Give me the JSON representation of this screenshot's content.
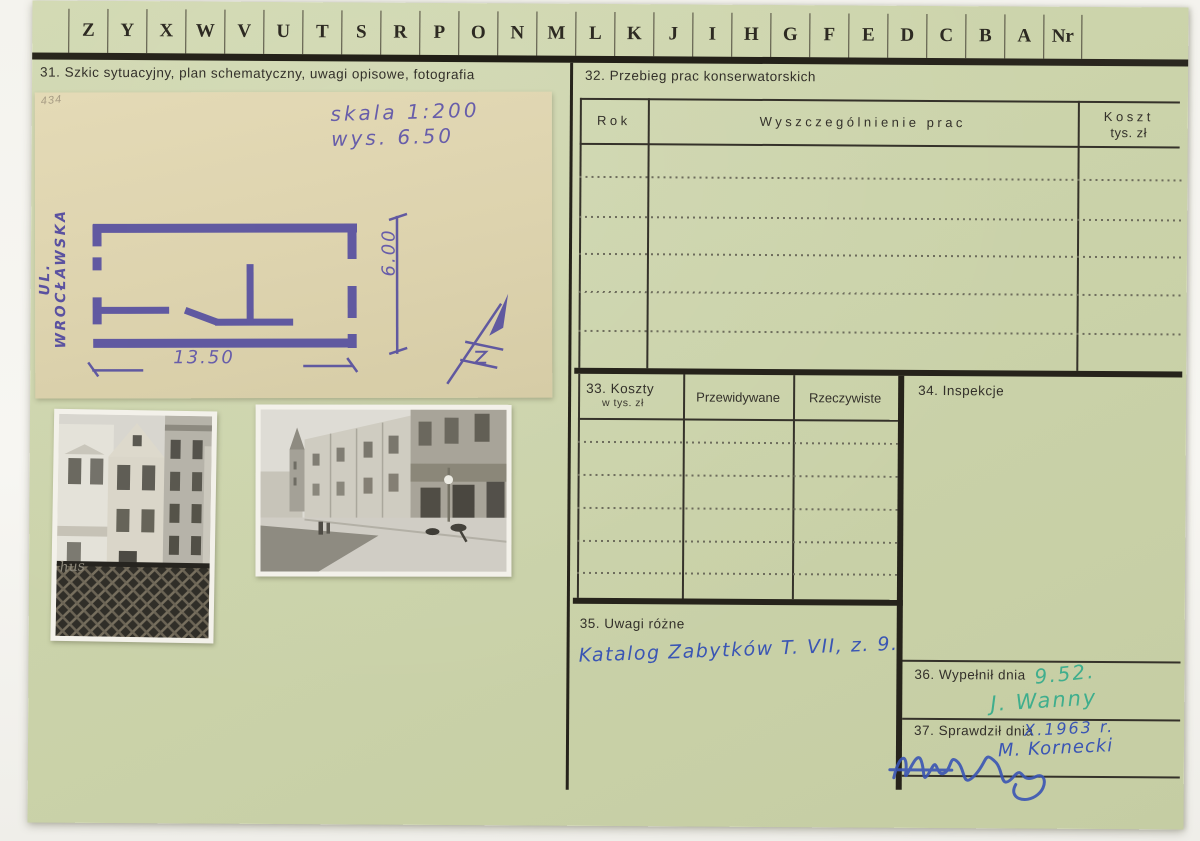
{
  "index_strip": {
    "letters": [
      "Z",
      "Y",
      "X",
      "W",
      "V",
      "U",
      "T",
      "S",
      "R",
      "P",
      "O",
      "N",
      "M",
      "L",
      "K",
      "J",
      "I",
      "H",
      "G",
      "F",
      "E",
      "D",
      "C",
      "B",
      "A",
      "Nr"
    ]
  },
  "sections": {
    "s31": {
      "label": "31. Szkic sytuacyjny, plan schematyczny, uwagi opisowe, fotografia"
    },
    "s32": {
      "label": "32. Przebieg prac konserwatorskich",
      "col_rok": "Rok",
      "col_prace": "Wyszczególnienie prac",
      "col_koszt": "Koszt",
      "col_koszt_sub": "tys. zł"
    },
    "s33": {
      "label": "33. Koszty",
      "sublabel": "w tys. zł",
      "col_przewidywane": "Przewidywane",
      "col_rzeczywiste": "Rzeczywiste"
    },
    "s34": {
      "label": "34. Inspekcje"
    },
    "s35": {
      "label": "35. Uwagi różne",
      "handwritten_note": "Katalog Zabytków T. VII, z. 9."
    },
    "s36": {
      "label": "36. Wypełnił dnia",
      "handwritten_date": "9.52.",
      "handwritten_signature": "J. Wanny"
    },
    "s37": {
      "label": "37. Sprawdził dnia",
      "handwritten_date": "X.1963 r.",
      "handwritten_signature": "M. Kornecki"
    }
  },
  "sketch": {
    "pencil_number": "434",
    "scale_note": "skala 1:200",
    "height_note": "wys. 6.50",
    "street_label": "UL. WROCŁAWSKA",
    "width_dim": "13.50",
    "height_dim": "6.00"
  },
  "photos": {
    "left_sign_text": "hus"
  },
  "colors": {
    "card": "#cbd3aa",
    "paper": "#ddd3ae",
    "ink_purple": "#564fa0",
    "ink_blue": "#3a55b4",
    "ink_green": "#3fae8d",
    "line_black": "#26231b"
  }
}
